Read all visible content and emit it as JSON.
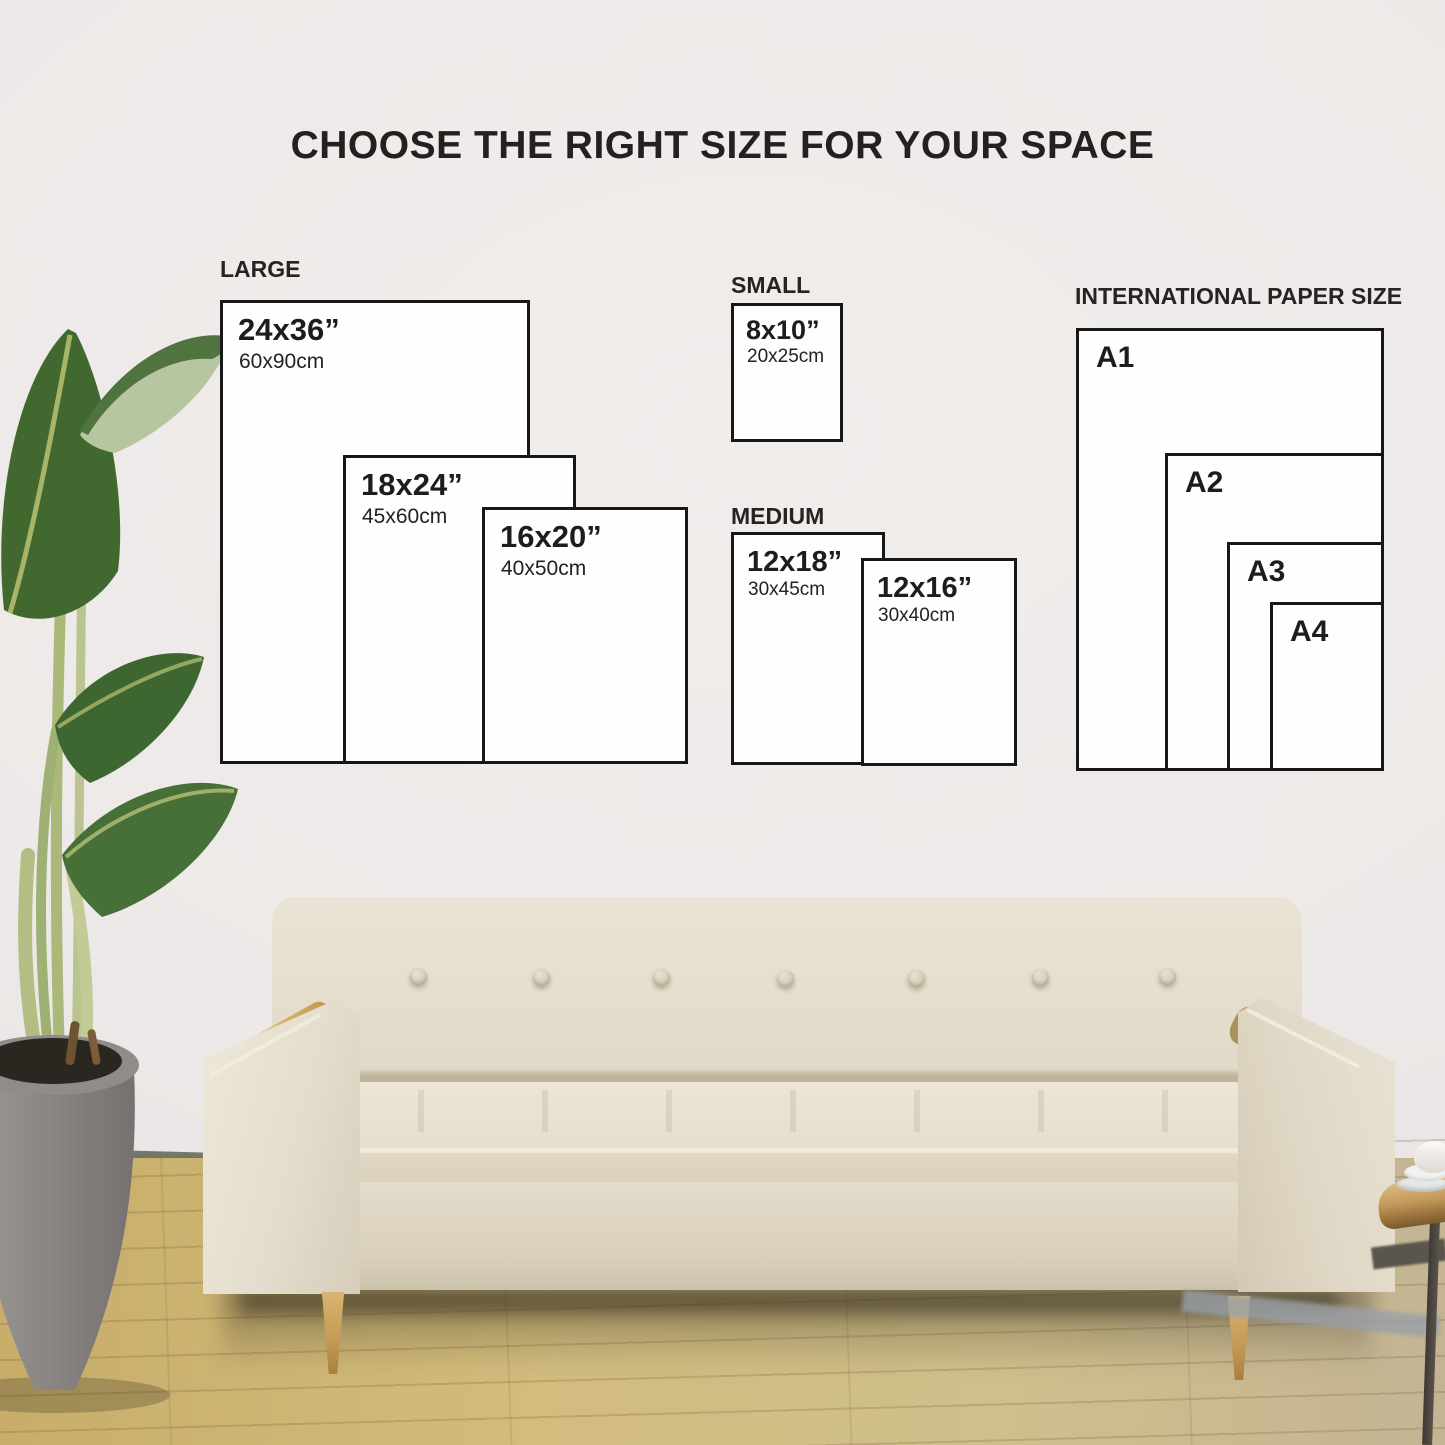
{
  "title": "CHOOSE THE RIGHT SIZE FOR YOUR SPACE",
  "groups": {
    "large": {
      "label": "LARGE",
      "sizes": [
        {
          "in": "24x36”",
          "cm": "60x90cm"
        },
        {
          "in": "18x24”",
          "cm": "45x60cm"
        },
        {
          "in": "16x20”",
          "cm": "40x50cm"
        }
      ]
    },
    "small": {
      "label": "SMALL",
      "sizes": [
        {
          "in": "8x10”",
          "cm": "20x25cm"
        }
      ]
    },
    "medium": {
      "label": "MEDIUM",
      "sizes": [
        {
          "in": "12x18”",
          "cm": "30x45cm"
        },
        {
          "in": "12x16”",
          "cm": "30x40cm"
        }
      ]
    },
    "international": {
      "label": "INTERNATIONAL PAPER SIZE",
      "sizes": [
        {
          "name": "A1"
        },
        {
          "name": "A2"
        },
        {
          "name": "A3"
        },
        {
          "name": "A4"
        }
      ]
    }
  },
  "colors": {
    "wall": "#eceae9",
    "floor_wood": "#d2bc7e",
    "baseboard": "#555a4d",
    "box_border": "#171717",
    "box_fill": "#fefefe",
    "text": "#1d1d1d",
    "sofa_fabric": "#e6decd",
    "sofa_wood": "#d3b269",
    "leaf_green": "#3d6631",
    "leaf_pale": "#b7c5a1",
    "pot_gray": "#8d8987",
    "table_wood": "#c59a5c"
  }
}
